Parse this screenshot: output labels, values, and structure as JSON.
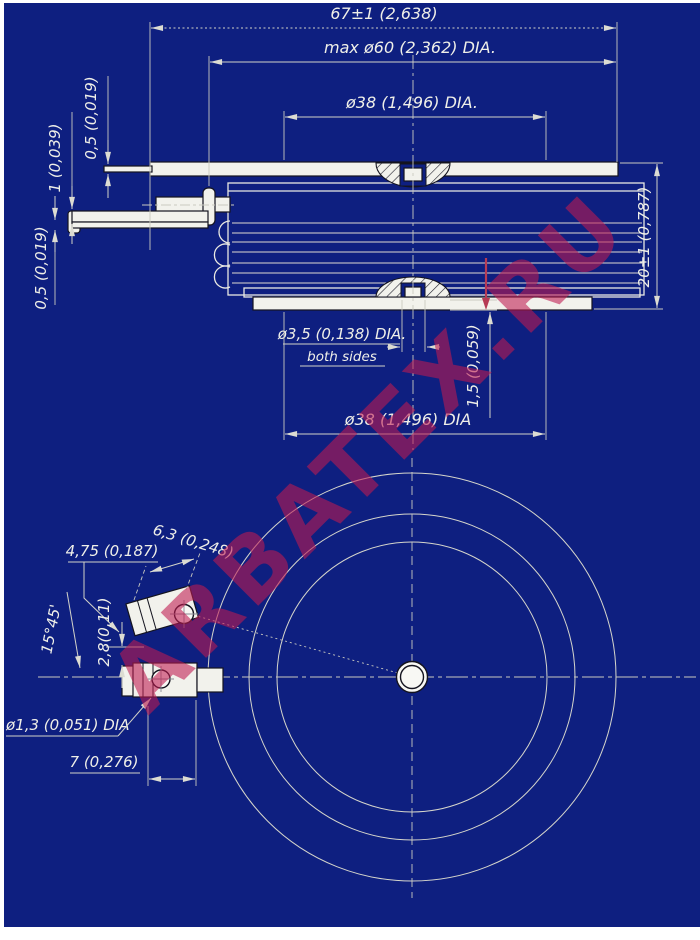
{
  "drawing": {
    "watermark": "ARBATEX.RU",
    "colors": {
      "background": "#0e1f80",
      "lines": "#e9e9e2",
      "watermark": "#c01a50",
      "metal": "#f2f2ec"
    },
    "side_view": {
      "overall_width": "67±1 (2,638)",
      "max_body_diameter": "max ø60 (2,362) DIA.",
      "top_pole_diameter": "ø38 (1,496) DIA.",
      "height": "20±1 (0,787)",
      "tab_thickness": "0,5 (0,019)",
      "lead_thickness": "1 (0,039)",
      "lead2_thickness": "0,5 (0,019)",
      "recess_diameter": "ø3,5 (0,138) DIA.",
      "recess_note": "both sides",
      "bottom_pole_diameter": "ø38 (1,496) DIA",
      "recess_depth": "1,5 (0,059)"
    },
    "bottom_view": {
      "lug_width": "4,75 (0,187)",
      "lug_length": "6,3 (0,248)",
      "lug_angle": "15°45'",
      "lug_offset": "2,8(0,11)",
      "hole_diameter": "ø1,3 (0,051) DIA",
      "terminal_length": "7 (0,276)"
    }
  }
}
